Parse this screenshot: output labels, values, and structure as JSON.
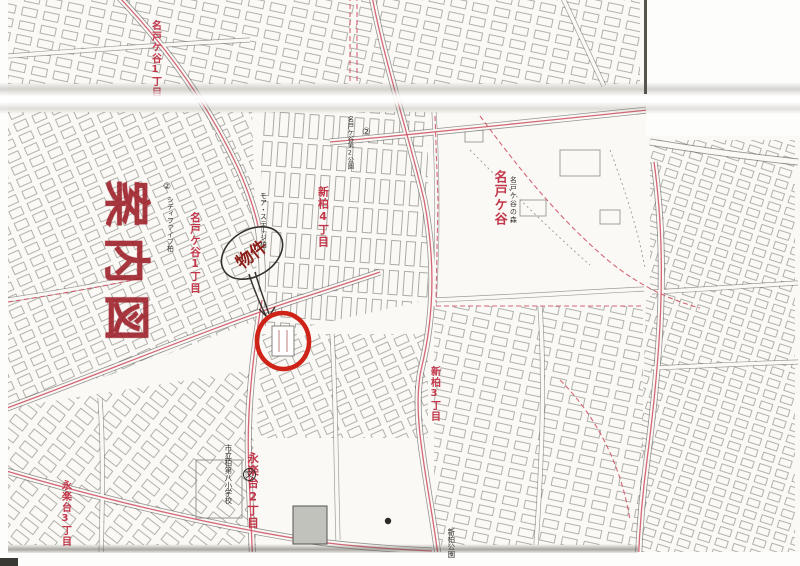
{
  "page": {
    "kind": "scanned guide map (case location map)",
    "stamp_title": "案内図",
    "annotation": {
      "property_label": "物件"
    },
    "colors": {
      "district_label_red": "#c2364a",
      "stamp_red": "#9c1c26",
      "marker_circle_red": "#cf2318",
      "boundary_line_red": "#cf5568",
      "map_ink": "#45433f",
      "paper": "#faf9f5"
    },
    "map_labels": [
      {
        "text": "名戸ケ谷1丁目",
        "role": "district"
      },
      {
        "text": "名戸ケ谷1丁目",
        "role": "district"
      },
      {
        "text": "新柏4丁目",
        "role": "district"
      },
      {
        "text": "新柏3丁目",
        "role": "district"
      },
      {
        "text": "名戸ケ谷",
        "role": "district"
      },
      {
        "text": "名戸ケ谷の森",
        "role": "poi"
      },
      {
        "text": "名戸ケ谷第2公園",
        "role": "poi"
      },
      {
        "text": "永楽台2丁目",
        "role": "district"
      },
      {
        "text": "永楽台3丁目",
        "role": "district"
      },
      {
        "text": "市立柏第八小学校",
        "role": "poi"
      },
      {
        "text": "シティファイブ柏",
        "role": "poi"
      },
      {
        "text": "モア・ステージ柏",
        "role": "poi"
      },
      {
        "text": "新柏公園",
        "role": "poi"
      }
    ],
    "symbols": {
      "school_mark": "文",
      "circled_two": "②"
    }
  }
}
